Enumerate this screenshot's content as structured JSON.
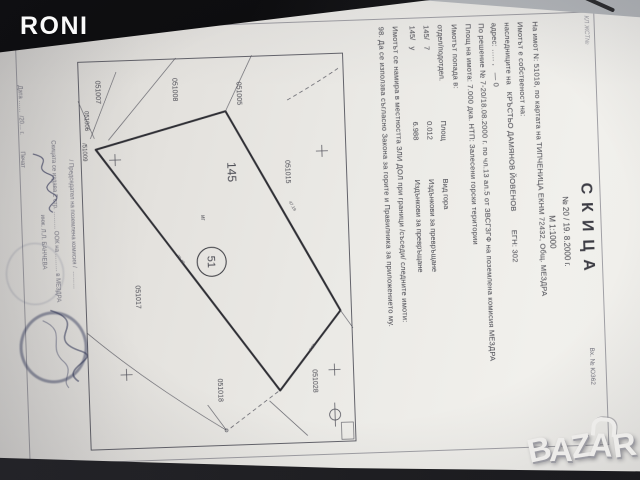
{
  "watermarks": {
    "photo_owner": "RONI",
    "marketplace_letters": [
      "B",
      "A",
      "Z",
      "A",
      "R"
    ]
  },
  "document": {
    "corner_note": "КЛ ЖСТ№",
    "reg_no": "Вх. № Ю362",
    "title": "СКИЦА",
    "number_line": "№ 20   /   19. 8.2000 г.",
    "scale": "М 1:1000",
    "lines": [
      "На имот N: 51018, по картата на ТИПЧЕНИЦА ЕКНМ 72432, Общ. МЕЗДРА",
      "Имотът е собственост на:",
      "наследниците на   КРЪСТЬО ДАМЯНОВ ЙОВЕНОВ        ЕГН: 302",
      "адрес: ….. ,   — 0",
      "По решение № 7-20/18.08.2000 г. по чл.13 ал.5 от ЗВСГЗГФ на поземлена комисия МЕЗДРА",
      "Площ на имота: 7.000 дка. НТП: Залесени горски територии",
      "Имотът попада в:"
    ],
    "table": {
      "columns": [
        "отдел/подотдел.",
        "Площ",
        "Вид гора"
      ],
      "rows": [
        {
          "subdivision": "145/   7",
          "area": "0.012",
          "forest_type": "Издънкови за превръщане"
        },
        {
          "subdivision": "145/   у",
          "area": "6.988",
          "forest_type": "Издънкови за превръщане"
        }
      ]
    },
    "lines2": [
      "Имотът се намира в местността ЗЛИ ДОЛ при граници /съседи/ следните имоти:",
      "98. Да се използва съгласно Закона за горите и Правилника за приложението му."
    ],
    "map": {
      "parcel_number": "51",
      "compartment": "145",
      "subparcel": "иг",
      "neighbors": {
        "n1": "051005",
        "n2": "051008",
        "n3": "051007",
        "n4": "051006",
        "n5": "/51009",
        "n6": "051015",
        "n7": "051028",
        "n8": "051018",
        "n9": "051017"
      },
      "edge_lengths": {
        "e1": "47.19",
        "e2": "29.40",
        "e3": "15.8"
      }
    },
    "footer": {
      "chairman_line": "/ Председател на поземлена комисия /  ………",
      "issue_note": "Скицата се издава 2 стр. ……… ООК на ……… в МЕЗДРА",
      "officer": "инж. Л.Л. БАНЧЕВА",
      "date_line": "Дата ……  /20… г.          Печат"
    }
  }
}
